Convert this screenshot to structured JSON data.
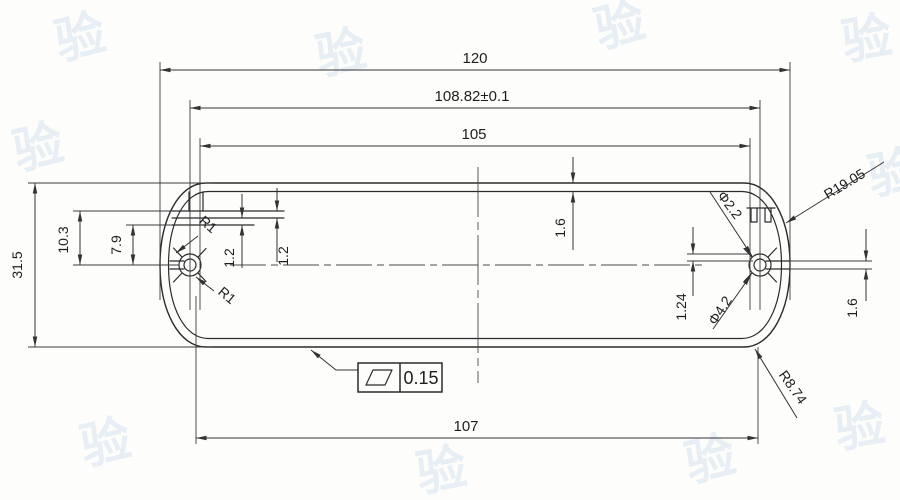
{
  "drawing": {
    "type": "engineering-cross-section",
    "dims": {
      "overall_width": "120",
      "boss_centers_width": "108.82±0.1",
      "inner_width": "105",
      "flat_width": "107",
      "overall_height": "31.5",
      "step_depth": "10.3",
      "groove_depth": "7.9",
      "rib_a": "1.2",
      "rib_b": "1.2",
      "top_wall": "1.6",
      "right_slot": "1.6",
      "boss_wall": "1.24",
      "fillet_a": "R1",
      "fillet_b": "R1",
      "end_radius": "R19.05",
      "corner_radius": "R8.74",
      "hole_diameter": "Φ2.2",
      "boss_diameter": "Φ4.2"
    },
    "flatness": {
      "symbol": "flatness-parallelogram",
      "value": "0.15"
    },
    "watermark": {
      "char": "验"
    },
    "colors": {
      "ink": "#2b2b2b",
      "paper": "#fdfdfc",
      "watermark": "#c6d8e8"
    }
  }
}
